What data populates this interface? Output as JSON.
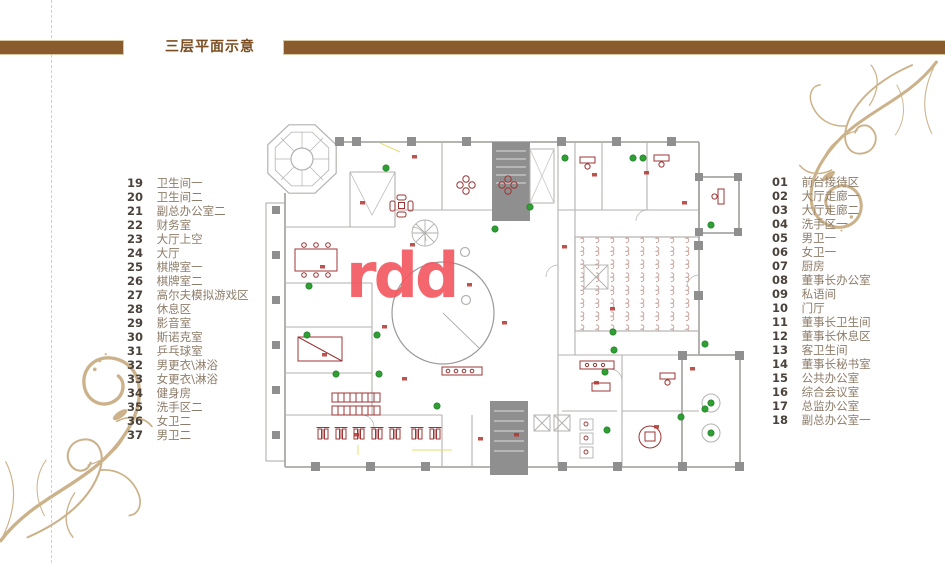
{
  "page": {
    "title": "三层平面示意"
  },
  "watermark": {
    "text": "rdd",
    "color": "#f2565e"
  },
  "legend_left": {
    "items": [
      {
        "num": "19",
        "label": "卫生间一"
      },
      {
        "num": "20",
        "label": "卫生间二"
      },
      {
        "num": "21",
        "label": "副总办公室二"
      },
      {
        "num": "22",
        "label": "财务室"
      },
      {
        "num": "23",
        "label": "大厅上空"
      },
      {
        "num": "24",
        "label": "大厅"
      },
      {
        "num": "25",
        "label": "棋牌室一"
      },
      {
        "num": "26",
        "label": "棋牌室二"
      },
      {
        "num": "27",
        "label": "高尔夫模拟游戏区"
      },
      {
        "num": "28",
        "label": "休息区"
      },
      {
        "num": "29",
        "label": "影音室"
      },
      {
        "num": "30",
        "label": "斯诺克室"
      },
      {
        "num": "31",
        "label": "乒乓球室"
      },
      {
        "num": "32",
        "label": "男更衣\\淋浴"
      },
      {
        "num": "33",
        "label": "女更衣\\淋浴"
      },
      {
        "num": "34",
        "label": "健身房"
      },
      {
        "num": "35",
        "label": "洗手区二"
      },
      {
        "num": "36",
        "label": "女卫二"
      },
      {
        "num": "37",
        "label": "男卫二"
      }
    ]
  },
  "legend_right": {
    "items": [
      {
        "num": "01",
        "label": "前台接待区"
      },
      {
        "num": "02",
        "label": "大厅走廊一"
      },
      {
        "num": "03",
        "label": "大厅走廊二"
      },
      {
        "num": "04",
        "label": "洗手区一"
      },
      {
        "num": "05",
        "label": "男卫一"
      },
      {
        "num": "06",
        "label": "女卫一"
      },
      {
        "num": "07",
        "label": "厨房"
      },
      {
        "num": "08",
        "label": "董事长办公室"
      },
      {
        "num": "09",
        "label": "私语间"
      },
      {
        "num": "10",
        "label": "门厅"
      },
      {
        "num": "11",
        "label": "董事长卫生间"
      },
      {
        "num": "12",
        "label": "董事长休息区"
      },
      {
        "num": "13",
        "label": "客卫生间"
      },
      {
        "num": "14",
        "label": "董事长秘书室"
      },
      {
        "num": "15",
        "label": "公共办公室"
      },
      {
        "num": "16",
        "label": "综合会议室"
      },
      {
        "num": "17",
        "label": "总监办公室"
      },
      {
        "num": "18",
        "label": "副总办公室一"
      }
    ]
  },
  "colors": {
    "title_brown": "#7c4f22",
    "bar_brown": "#8a5b2d",
    "legend_number": "#4a423b",
    "legend_label": "#8d7c69",
    "flourish_gold": "#ccb28a",
    "plan_wall_gray": "#aaa9a6",
    "plan_core_gray": "#8f8f8f",
    "plan_furniture_red": "#9c3434",
    "plan_plant_green": "#2f9e33",
    "watermark_coral": "#f2565e"
  }
}
